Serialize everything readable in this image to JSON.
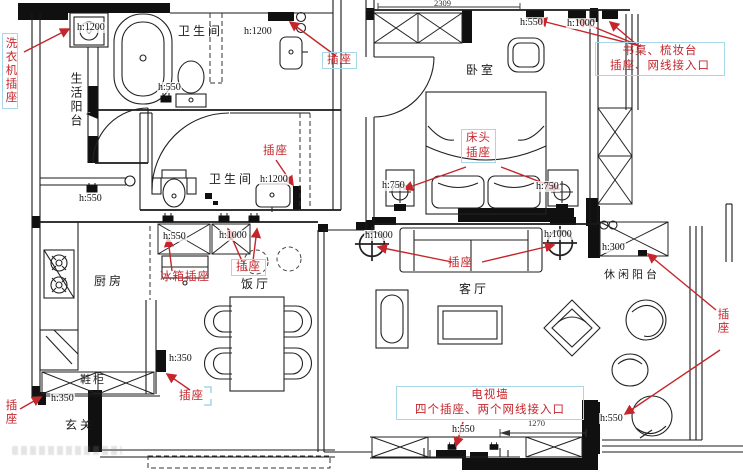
{
  "colors": {
    "annotation_red": "#c5262c",
    "label_box_blue": "#a8d8e8",
    "line_black": "#1a1a1a"
  },
  "rooms": {
    "life_balcony": "生活阳台",
    "bath_top": "卫生间",
    "bath_mid": "卫生间",
    "bedroom": "卧室",
    "kitchen": "厨房",
    "dining": "饭厅",
    "living": "客厅",
    "leisure": "休闲阳台",
    "entry": "玄关",
    "shoe": "鞋柜"
  },
  "dims": {
    "top": "2309",
    "tv": "1270"
  },
  "heights": {
    "washer": "h:1200",
    "toilet_top": "h:550",
    "sink_top": "h:1200",
    "counter": "h:550",
    "bath_mid": "h:1200",
    "fridge": "h:550",
    "dining": "h:1000",
    "bedroom_top_left": "h:550",
    "bedroom_top_right": "h:1000",
    "nightstand_left": "h:750",
    "nightstand_right": "h:750",
    "sofa_left": "h:1000",
    "sofa_right": "h:1000",
    "balcony_cabinet": "h:300",
    "balcony_floor": "h:550",
    "tv": "h:550",
    "shoe": "h:350",
    "entry": "h:350"
  },
  "outlets": {
    "washer": "洗衣机插座",
    "bath_top": "插座",
    "bath_mid": "插座",
    "desk_line1": "书桌、梳妆台",
    "desk_line2": "插座、网线接入口",
    "bed_line1": "床头",
    "bed_line2": "插座",
    "sofa": "插座",
    "dining": "插座",
    "fridge": "冰箱插座",
    "tv_line1": "电视墙",
    "tv_line2": "四个插座、两个网线接入口",
    "balcony": "插座",
    "entry_left": "插座",
    "entry_hall": "插座"
  }
}
